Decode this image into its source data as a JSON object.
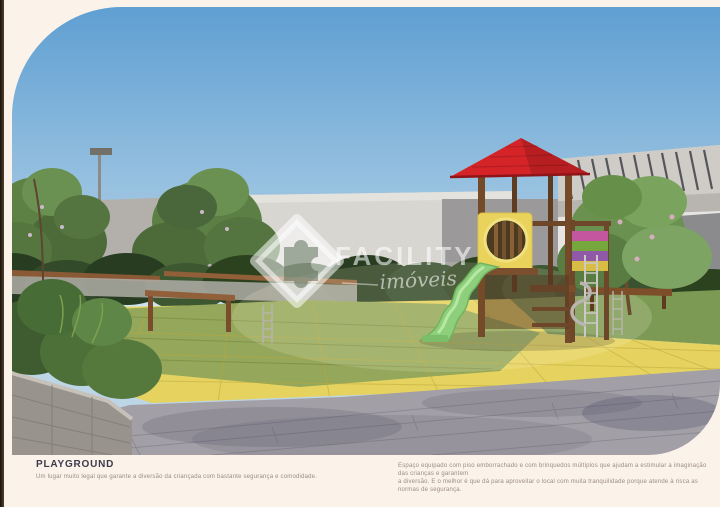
{
  "watermark": {
    "brand": "FACILITY",
    "subtitle": "imóveis"
  },
  "caption": {
    "title": "PLAYGROUND",
    "subtitle": "Um lugar muito legal que garante a diversão da criançada com bastante segurança e comodidade.",
    "description_line1": "Espaço equipado com piso emborrachado e com brinquedos múltiplos que ajudam a estimular a imaginação das crianças e garantem",
    "description_line2": "a diversão. E o melhor é que dá para aproveitar o local com muita tranquilidade porque atende à risca as normas de segurança."
  },
  "colors": {
    "page_background": "#fbf2ea",
    "caption_title": "#3c3b49",
    "caption_text": "#9b8d80",
    "watermark_white": "rgba(255,255,255,0.58)",
    "roof_red": "#d42428",
    "slide_green": "#8ecf7b",
    "floor_yellow": "#e6d35f",
    "floor_green": "#94a75b",
    "pavement_gray": "#a39fa6",
    "sky_blue": "#5f9fd2"
  }
}
